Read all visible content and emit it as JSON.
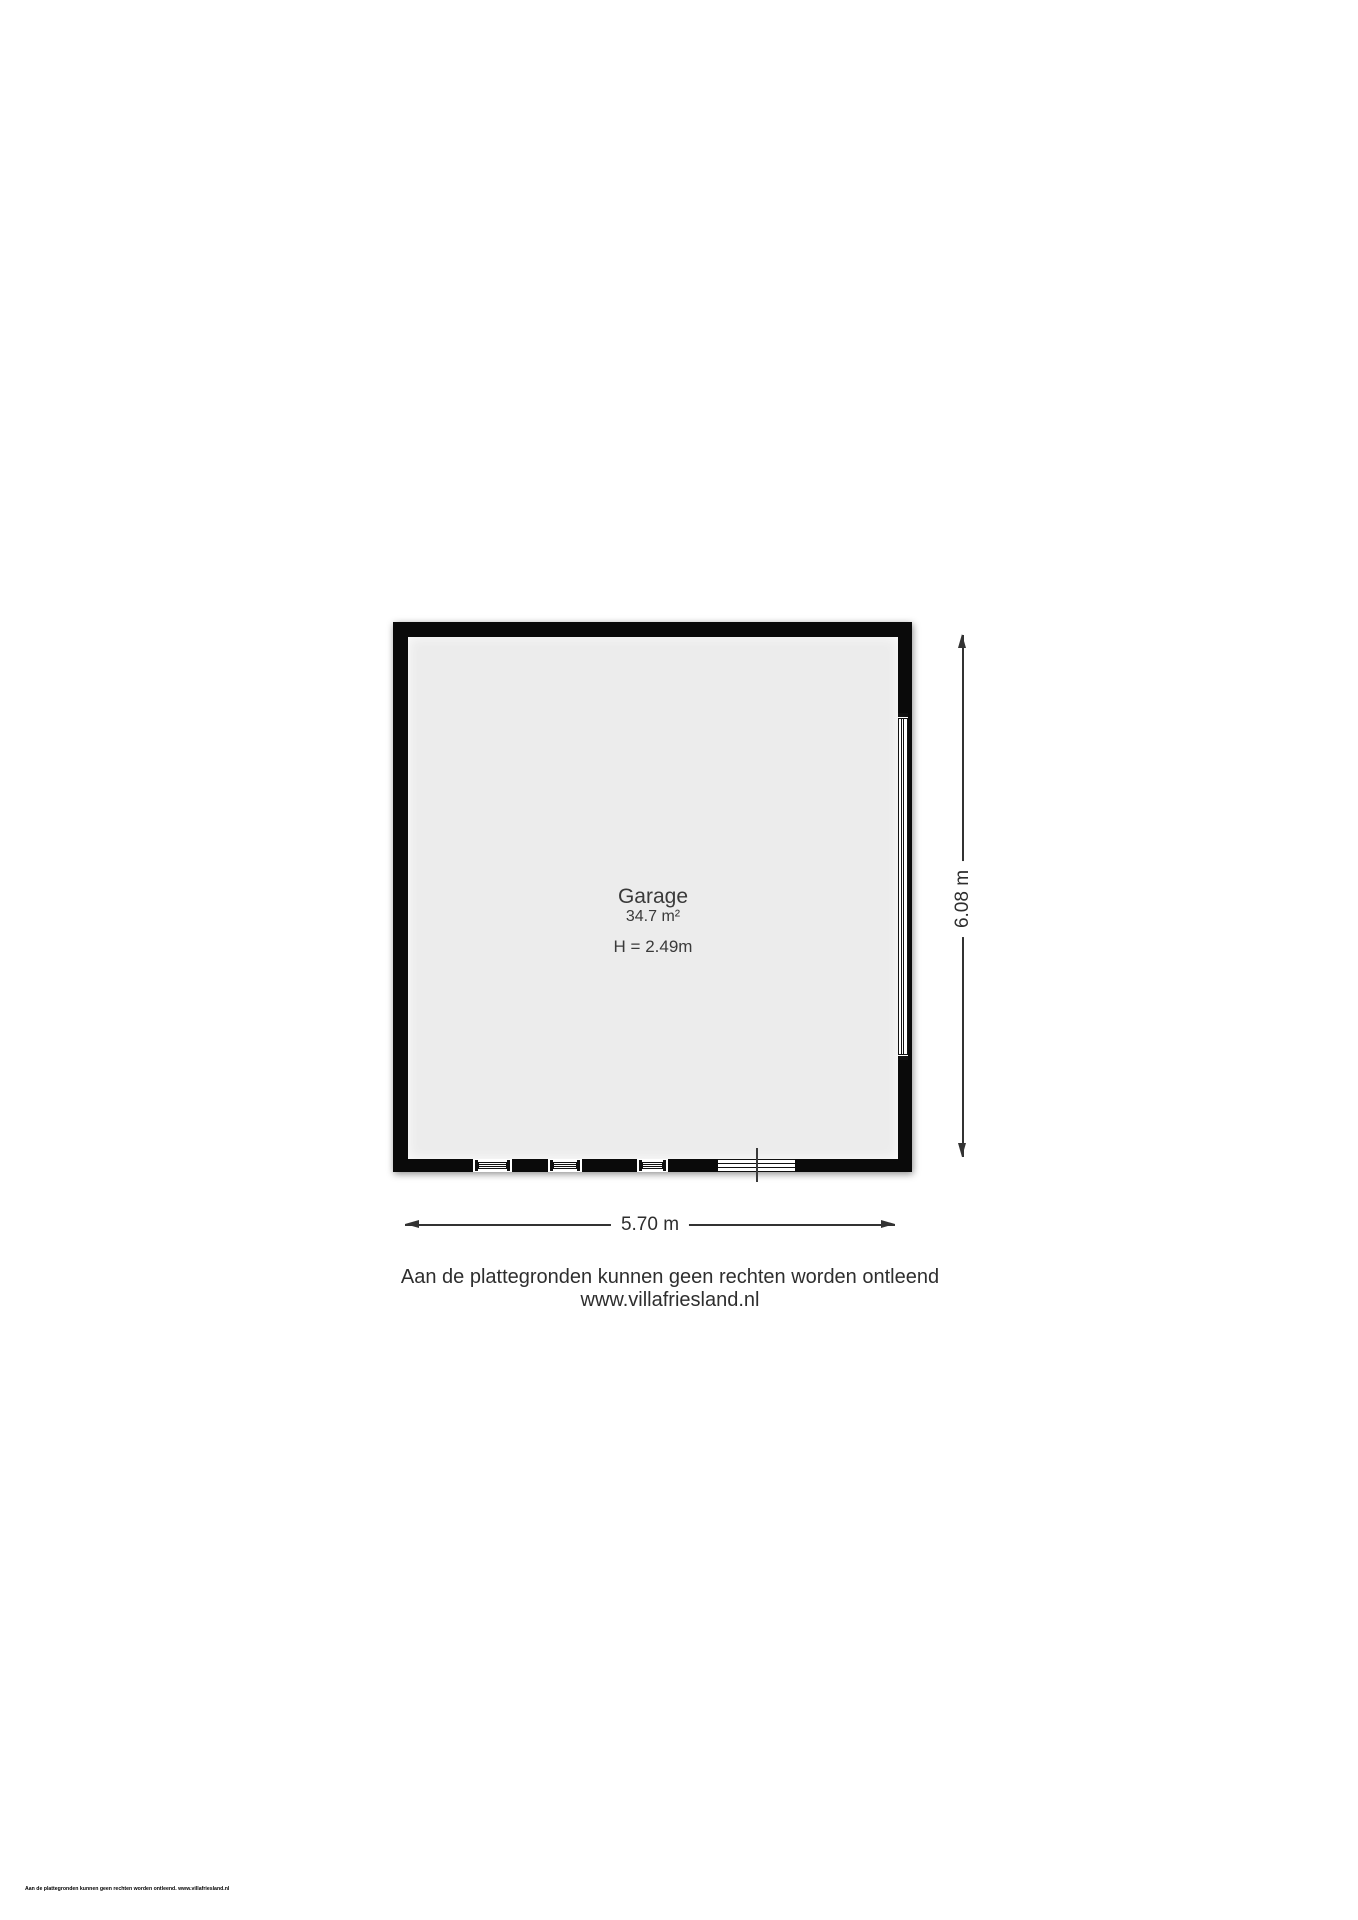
{
  "colors": {
    "wall": "#0a0a0a",
    "floor": "#ececec",
    "line": "#333333",
    "text": "#3a3a3a"
  },
  "room": {
    "name": "Garage",
    "area": "34.7 m²",
    "ceiling_height": "H = 2.49m"
  },
  "dimensions": {
    "width_label": "5.70 m",
    "height_label": "6.08 m"
  },
  "disclaimer": {
    "line1": "Aan de plattegronden kunnen geen rechten worden ontleend",
    "line2": "www.villafriesland.nl"
  },
  "fineprint": "Aan de plattegronden kunnen geen rechten worden ontleend. www.villafriesland.nl"
}
